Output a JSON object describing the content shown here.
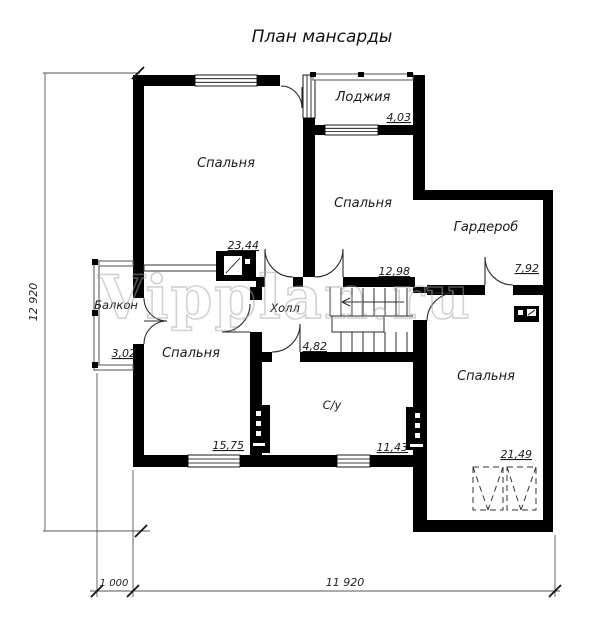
{
  "title": "План мансарды",
  "watermark": "Vipplan.ru",
  "rooms": {
    "bedroom_top_left": {
      "label": "Спальня",
      "area": "23,44"
    },
    "loggia": {
      "label": "Лоджия",
      "area": "4,03"
    },
    "bedroom_middle": {
      "label": "Спальня",
      "area": "12,98"
    },
    "wardrobe": {
      "label": "Гардероб",
      "area": "7,92"
    },
    "balcony": {
      "label": "Балкон",
      "area": "3,02"
    },
    "hall": {
      "label": "Холл",
      "area": "4,82"
    },
    "bedroom_bottom_left": {
      "label": "Спальня",
      "area": "15,75"
    },
    "bathroom": {
      "label": "С/у",
      "area": "11,43"
    },
    "bedroom_bottom_right": {
      "label": "Спальня",
      "area": "21,49"
    }
  },
  "dimensions": {
    "height_total": "12 920",
    "offset_left": "1 000",
    "width_total": "11 920"
  },
  "colors": {
    "wall": "#000000",
    "thin_wall": "#6e6e6e",
    "watermark": "#a6a6a6"
  }
}
